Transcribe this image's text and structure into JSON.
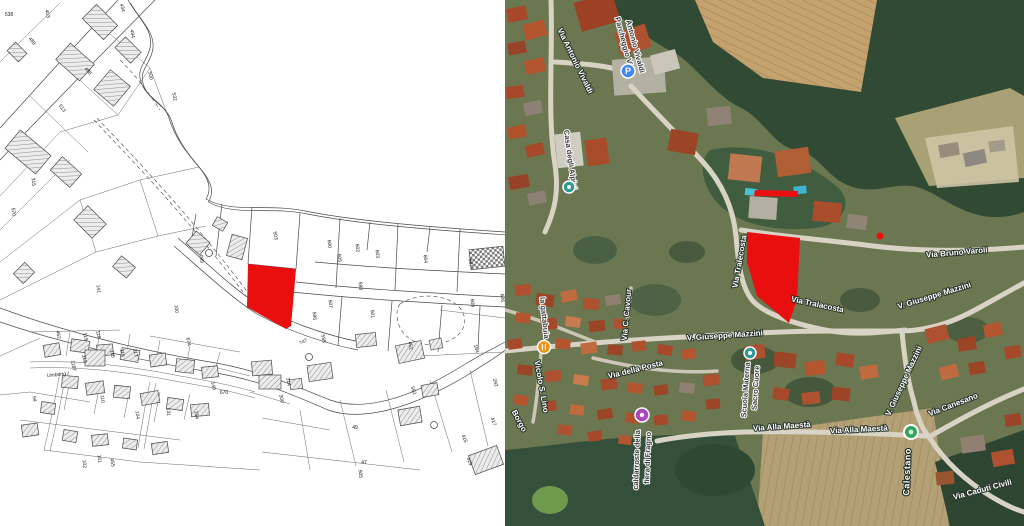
{
  "colors": {
    "red_parcel": "#e90f0f",
    "parking_blue": "#4285f4",
    "poi_teal": "#2f9a94",
    "restaurant_orange": "#f29111",
    "event_purple": "#ab47bc",
    "town_green": "#31a35a"
  },
  "cadastral": {
    "street": "Umberto I",
    "nums": [
      "403",
      "434",
      "494",
      "489",
      "538",
      "500",
      "488",
      "513",
      "532",
      "570",
      "141",
      "315",
      "100",
      "099",
      "503",
      "600",
      "602",
      "603",
      "604",
      "605",
      "607",
      "608",
      "606",
      "598",
      "596",
      "595",
      "501",
      "507",
      "747",
      "592",
      "462",
      "119",
      "118",
      "117",
      "116",
      "115",
      "113",
      "110",
      "131",
      "154",
      "124",
      "140",
      "674",
      "670",
      "455",
      "452",
      "417",
      "429",
      "415",
      "314",
      "300",
      "164",
      "292",
      "505",
      "49",
      "47",
      "102",
      "101",
      "1187",
      "94"
    ]
  },
  "satellite": {
    "parking_glyph": "P",
    "labels": [
      "Via Antonio Vivaldi",
      "Parcheggio Via",
      "Antonio Vivaldi",
      "Casa degli Alpini",
      "la gattabuia",
      "Vicolo S. Lino",
      "Borgo",
      "Via della Posta",
      "caldarroste della",
      "fiera di Fragno",
      "Scuola Materna",
      "Sacro Cuore",
      "V. Giuseppe Mazzini",
      "V. Giuseppe Mazzini",
      "V. Giuseppe Mazzini",
      "Via Bruno Varoli",
      "Via Canesano",
      "Via Alla Maestà",
      "Via Alla Maestà",
      "Calestano",
      "Via Caduti Civili",
      "Via Tralecosta",
      "Via Tralacosta",
      "Via C. Cavour"
    ]
  }
}
